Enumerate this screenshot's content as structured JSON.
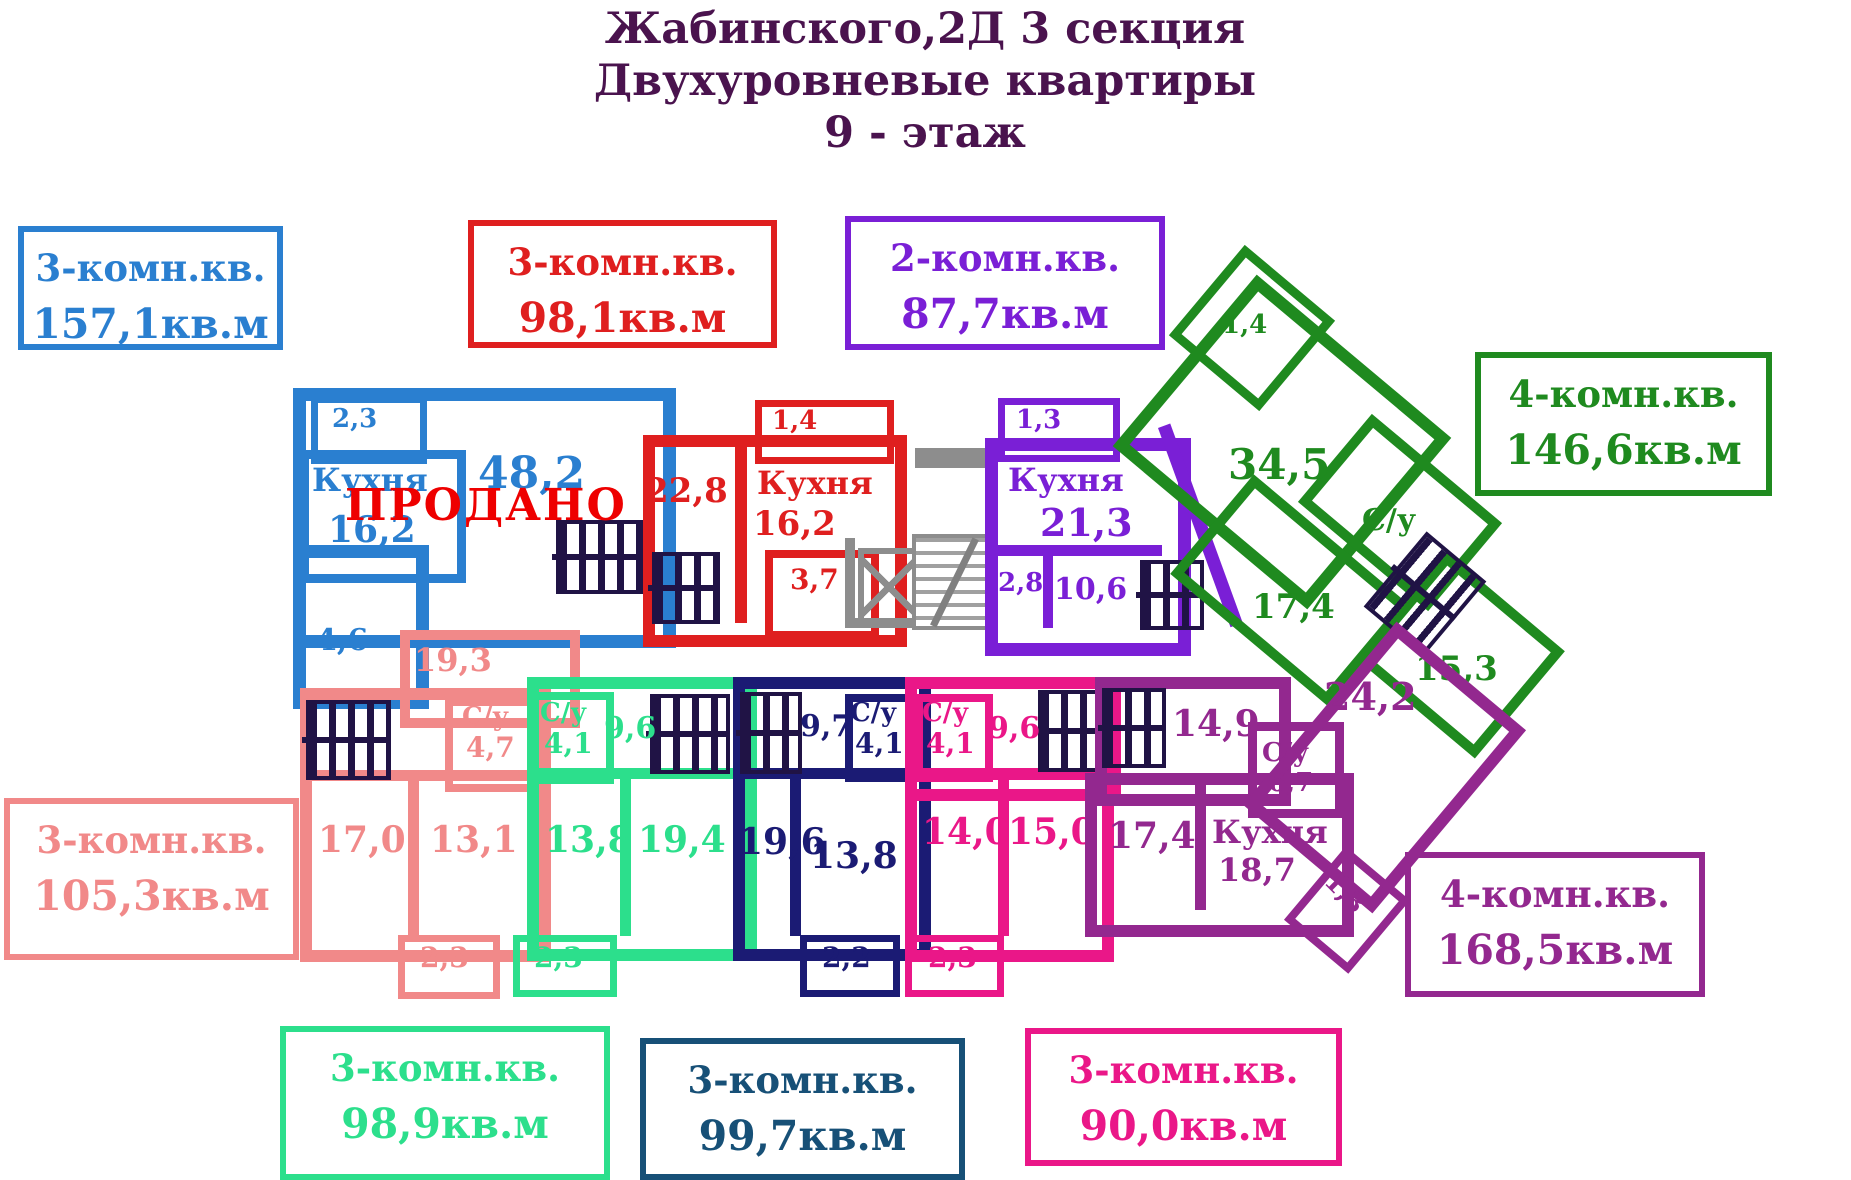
{
  "title": {
    "l1": "Жабинского,2Д  3 секция",
    "l2": "Двухуровневые квартиры",
    "l3": "9 - этаж"
  },
  "legends": {
    "blue": {
      "type": "3-комн.кв.",
      "area": "157,1кв.м"
    },
    "red": {
      "type": "3-комн.кв.",
      "area": "98,1кв.м"
    },
    "violet": {
      "type": "2-комн.кв.",
      "area": "87,7кв.м"
    },
    "green": {
      "type": "4-комн.кв.",
      "area": "146,6кв.м"
    },
    "salmon": {
      "type": "3-комн.кв.",
      "area": "105,3кв.м"
    },
    "plum": {
      "type": "4-комн.кв.",
      "area": "168,5кв.м"
    },
    "spring": {
      "type": "3-комн.кв.",
      "area": "98,9кв.м"
    },
    "navy": {
      "type": "3-комн.кв.",
      "area": "99,7кв.м"
    },
    "magenta": {
      "type": "3-комн.кв.",
      "area": "90,0кв.м"
    }
  },
  "rooms": {
    "blue": {
      "balcony": "2,3",
      "kitchen": "Кухня",
      "kitchen_area": "16,2",
      "living": "48,2",
      "hall": "4,6",
      "sold": "ПРОДАНО"
    },
    "red": {
      "room": "22,8",
      "balcony": "1,4",
      "kitchen": "Кухня",
      "kitchen_area": "16,2",
      "small": "3,7"
    },
    "violet": {
      "balcony": "1,3",
      "kitchen": "Кухня",
      "kitchen_area": "21,3",
      "small": "2,8",
      "room": "10,6"
    },
    "green": {
      "balcony": "1,4",
      "living": "34,5",
      "wc": "С/у",
      "room1": "17,4",
      "room2": "15,3"
    },
    "salmon": {
      "top": "19,3",
      "wc": "С/у",
      "wc_area": "4,7",
      "room1": "17,0",
      "room2": "13,1",
      "balcony": "2,3"
    },
    "spring": {
      "wc": "С/у",
      "wc_area": "4,1",
      "hall": "9,6",
      "room1": "13,8",
      "room2": "19,4",
      "balcony": "2,3"
    },
    "navy": {
      "hall": "9,7",
      "wc": "С/у",
      "wc_area": "4,1",
      "room1": "19,6",
      "room2": "13,8",
      "balcony": "2,2"
    },
    "magenta": {
      "wc": "С/у",
      "wc_area": "4,1",
      "hall": "9,6",
      "room1": "14,0",
      "room2": "15,0",
      "balcony": "2,3"
    },
    "plum": {
      "hall": "14,9",
      "wc": "С/у",
      "wc_area": "6,7",
      "room1": "17,4",
      "kitchen": "Кухня",
      "kitchen_area": "18,7",
      "living": "24,2",
      "balcony": "1,3"
    }
  },
  "colors": {
    "blue": "#2a7fd0",
    "red": "#df1f1f",
    "violet": "#7a1fd6",
    "green": "#1f8a1f",
    "salmon": "#f18989",
    "salmon_border": "#ec8a3c",
    "plum": "#93288f",
    "spring": "#2cdf8c",
    "navy": "#1b1b74",
    "navy_label": "#175077",
    "magenta": "#ea1788",
    "gray": "#8d8d8d",
    "title": "#4a134e",
    "sold": "#ee0000",
    "stairs": "#201345"
  }
}
